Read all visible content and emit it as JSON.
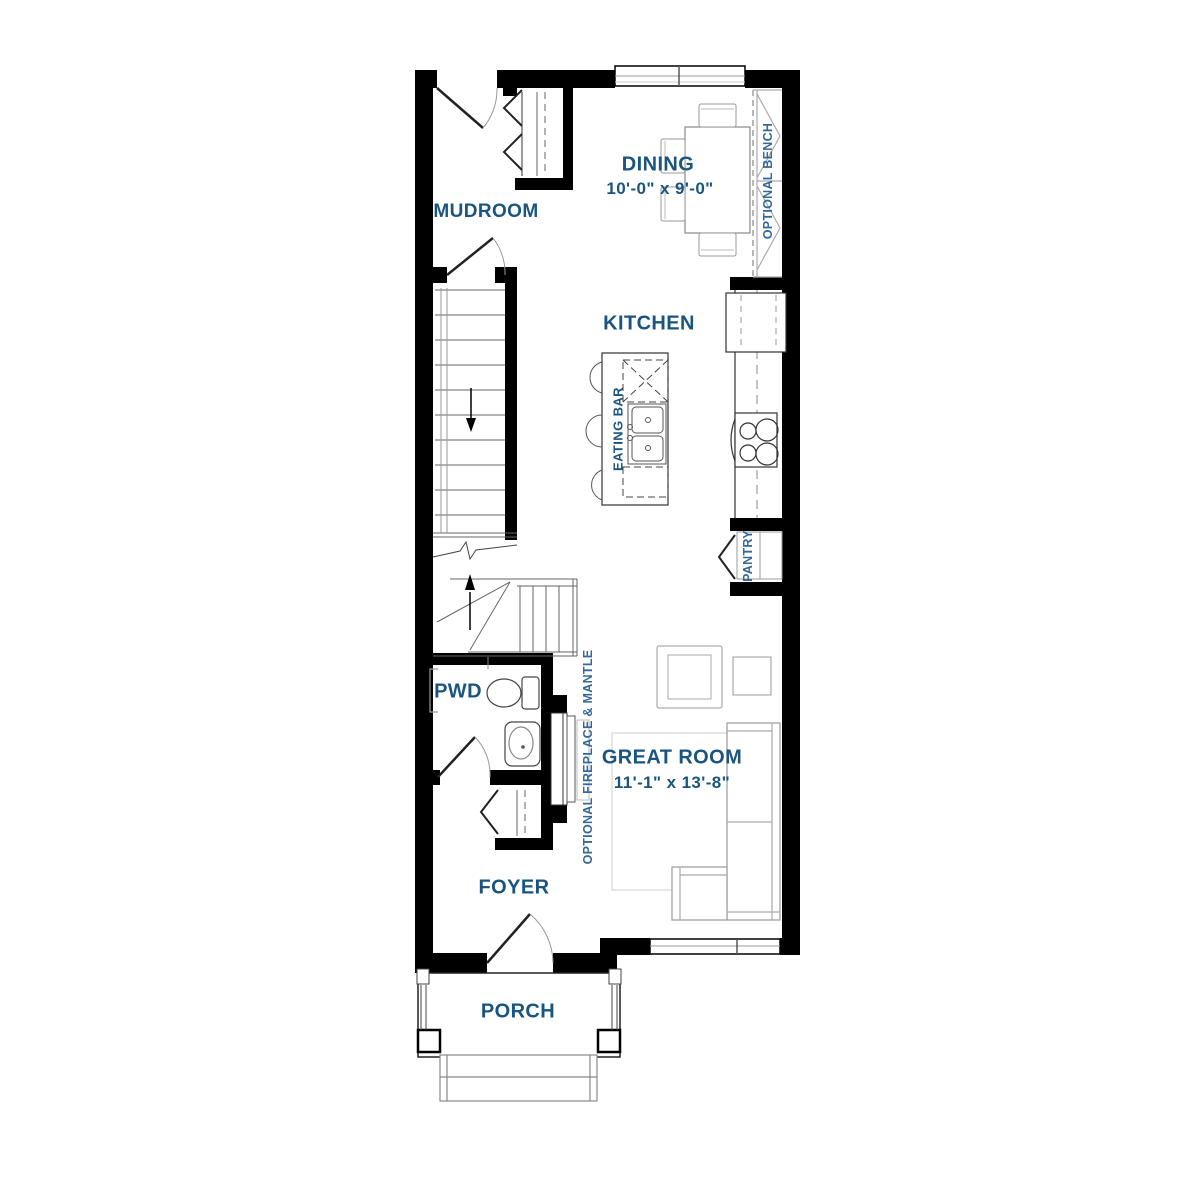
{
  "theme": {
    "label_color": "#1a5480",
    "annotation_color": "#35689a",
    "wall_color": "#000000",
    "fixture_line_color": "#333333",
    "furniture_line_color": "#999999",
    "background": "#ffffff"
  },
  "labels": {
    "mudroom": "MUDROOM",
    "dining": "DINING",
    "dining_dims": "10'-0\" x 9'-0\"",
    "kitchen": "KITCHEN",
    "eating_bar": "EATING BAR",
    "pantry": "PANTRY",
    "optional_bench": "OPTIONAL BENCH",
    "optional_fireplace": "OPTIONAL FIREPLACE & MANTLE",
    "pwd": "PWD",
    "great_room": "GREAT ROOM",
    "great_room_dims": "11'-1\" x 13'-8\"",
    "foyer": "FOYER",
    "porch": "PORCH"
  }
}
